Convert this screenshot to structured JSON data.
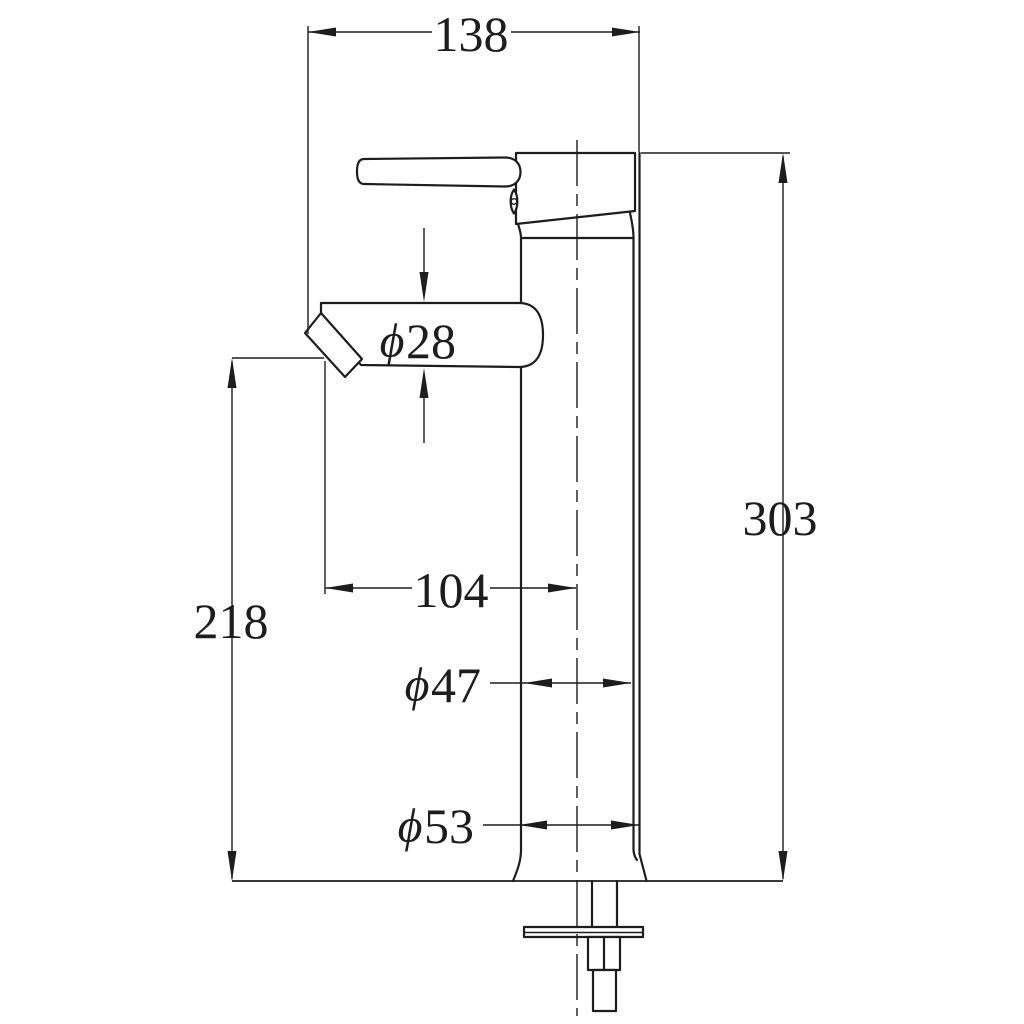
{
  "drawing": {
    "background": "#ffffff",
    "line_color": "#1d1d1d",
    "dimensions": {
      "spout_projection": {
        "value": "138"
      },
      "overall_height": {
        "value": "303"
      },
      "spout_outlet_height": {
        "value": "218"
      },
      "spout_reach": {
        "value": "104"
      },
      "spout_tube_diameter": {
        "symbol": "ϕ",
        "value": "28"
      },
      "body_diameter": {
        "symbol": "ϕ",
        "value": "47"
      },
      "base_diameter": {
        "symbol": "ϕ",
        "value": "53"
      }
    }
  }
}
